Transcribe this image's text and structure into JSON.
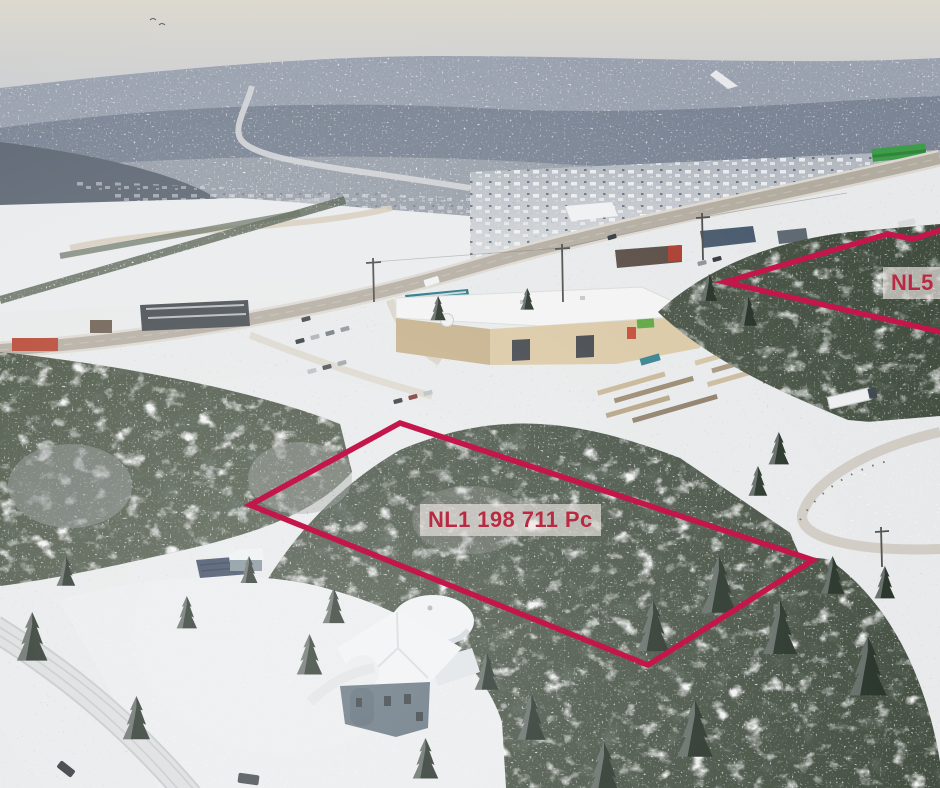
{
  "annotations": {
    "line_color": "#c4164b",
    "label_text_color": "#b82a42",
    "label_background_color": "rgba(238,231,227,0.66)",
    "lot1": {
      "label": "NL1 198 711 Pc"
    },
    "lot2": {
      "label": "NL5 1"
    }
  }
}
